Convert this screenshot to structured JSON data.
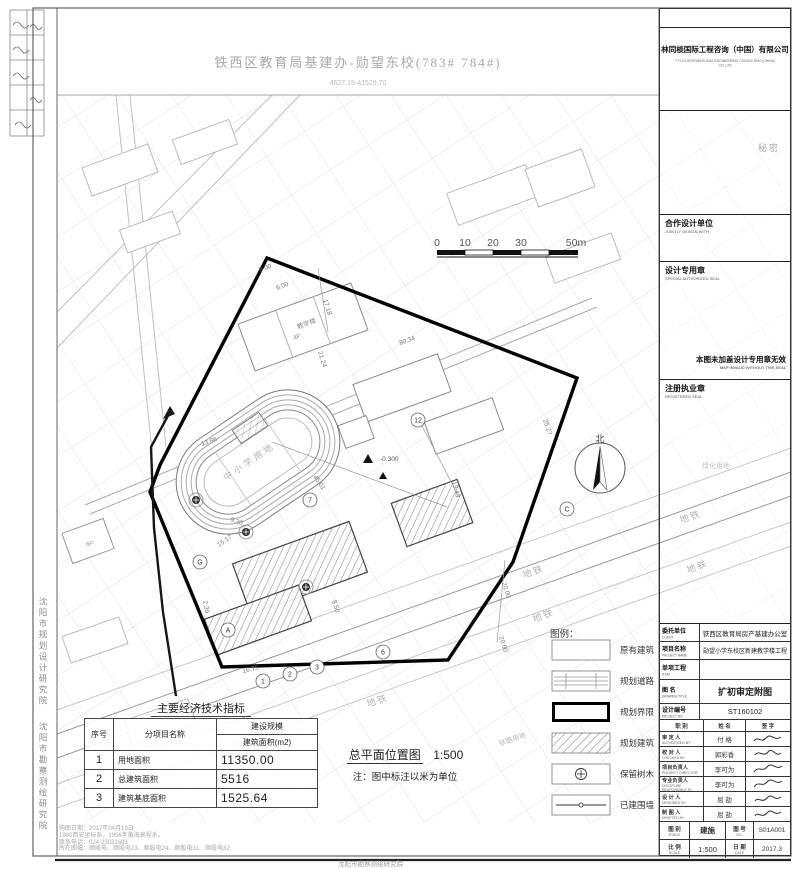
{
  "sheet": {
    "title": "铁西区教育局基建办-勋望东校(783# 784#)",
    "subtitle": "4627.15-41529.70",
    "security": "秘密"
  },
  "company": {
    "name_cn": "林同棪国际工程咨询（中国）有限公司",
    "name_en": "T.Y.LIN INTERNATIONAL ENGINEERING CONSULTING (CHINA) CO.,LTD"
  },
  "stamps": {
    "joint_cn": "合作设计单位",
    "joint_en": "JOINTLY DESIGN WITH",
    "seal_cn": "设计专用章",
    "seal_en": "SPECIAL AUTHORIZED SEAL",
    "invalid_cn": "本图未加盖设计专用章无效",
    "invalid_en": "MAP INVALID WITHOUT THIS SEAL",
    "registered_cn": "注册执业章",
    "registered_en": "REGISTERED SEAL"
  },
  "titleblock": {
    "rows": [
      {
        "label": "委托单位",
        "en": "CLIENT",
        "value": "铁西区教育局房产基建办公室"
      },
      {
        "label": "项目名称",
        "en": "PROJECT NAME",
        "value": "勋望小学东校区新建教学楼工程"
      },
      {
        "label": "单项工程",
        "en": "ITEM",
        "value": ""
      },
      {
        "label": "图    名",
        "en": "DRAWING TITLE",
        "value": "扩初审定附图"
      },
      {
        "label": "设计编号",
        "en": "PROJECT NO.",
        "value": "ST160102"
      }
    ],
    "header": {
      "pos": "职  别",
      "pos_en": "POSITION",
      "name": "姓  名",
      "name_en": "NAME",
      "sig": "签  字",
      "sig_en": "SIGNATURE"
    },
    "signers": [
      {
        "role": "审 定 人",
        "en": "AUTHORIZED BY",
        "name": "付 格"
      },
      {
        "role": "校 对 人",
        "en": "CHECKED BY",
        "name": "郭彩香"
      },
      {
        "role": "项目负责人",
        "en": "PROJECT DIRECTOR",
        "name": "李可为"
      },
      {
        "role": "专业负责人",
        "en": "DISCIPLINE RESPONSIBLE BY",
        "name": "李可为"
      },
      {
        "role": "设 计 人",
        "en": "DESIGNED BY",
        "name": "屈 劼"
      },
      {
        "role": "制 图 人",
        "en": "DRAFTED BY",
        "name": "屈 劼"
      }
    ],
    "footer": {
      "stage_label": "图 别",
      "stage_en": "STAGE",
      "stage": "建施",
      "no_label": "图 号",
      "no_en": "NO.",
      "no": "S01A001",
      "scale_label": "比 例",
      "scale_en": "SCALE",
      "scale": "1:500",
      "date_label": "日 期",
      "date_en": "DATE",
      "date": "2017.3"
    }
  },
  "legend": {
    "title": "图例：",
    "items": [
      "原有建筑",
      "规划道路",
      "规划界限",
      "规划建筑",
      "保留树木",
      "已建围墙"
    ]
  },
  "econ_table": {
    "title": "主要经济技术指标",
    "col_no": "序号",
    "col_item": "分项目名称",
    "col_scale": "建设规模",
    "col_area": "建筑面积(m2)",
    "rows": [
      [
        "1",
        "用地面积",
        "11350.00"
      ],
      [
        "2",
        "总建筑面积",
        "5516"
      ],
      [
        "3",
        "建筑基底面积",
        "1525.64"
      ]
    ]
  },
  "caption": {
    "main": "总平面位置图",
    "scale": "1:500",
    "note": "注：图中标注以米为单位"
  },
  "scalebar": {
    "ticks": [
      "0",
      "10",
      "20",
      "30",
      "50m"
    ]
  },
  "plan": {
    "north": "北",
    "labels": [
      {
        "t": "中小学用地"
      },
      {
        "t": "地铁"
      },
      {
        "t": "地铁"
      },
      {
        "t": "地铁"
      },
      {
        "t": "地铁"
      },
      {
        "t": "地铁"
      },
      {
        "t": "铁路用地"
      },
      {
        "t": "绿化用地"
      },
      {
        "t": "教学楼"
      },
      {
        "t": "4F"
      },
      {
        "t": "6F"
      },
      {
        "t": "-0.300"
      }
    ],
    "dims": [
      {
        "t": "17.18"
      },
      {
        "t": "6.00"
      },
      {
        "t": "8.00"
      },
      {
        "t": "80.34"
      },
      {
        "t": "21.24"
      },
      {
        "t": "25.27"
      },
      {
        "t": "13.43"
      },
      {
        "t": "45.01"
      },
      {
        "t": "15.17"
      },
      {
        "t": "9.30"
      },
      {
        "t": "13.86"
      },
      {
        "t": "2.39"
      },
      {
        "t": "16.75"
      },
      {
        "t": "8.50"
      },
      {
        "t": "20.00"
      },
      {
        "t": "20.00"
      }
    ],
    "bubbles": [
      {
        "t": "1"
      },
      {
        "t": "2"
      },
      {
        "t": "3"
      },
      {
        "t": "6"
      },
      {
        "t": "7"
      },
      {
        "t": "12"
      },
      {
        "t": "A"
      },
      {
        "t": "C"
      },
      {
        "t": "G"
      }
    ]
  },
  "notes": {
    "lines": [
      "购图日期：2017年04月19日",
      "1980西安坐标系，1956年黄海高程系。",
      "联系电话：024-23031603",
      "所在图幅：顺股电、顺股电23、顺股电24、顺股电31、顺股电32"
    ],
    "credit": "沈阳市勘察测绘研究院"
  },
  "institutes": {
    "a": "沈阳市规划设计研究院",
    "b": "沈阳市勘察测绘研究院"
  }
}
